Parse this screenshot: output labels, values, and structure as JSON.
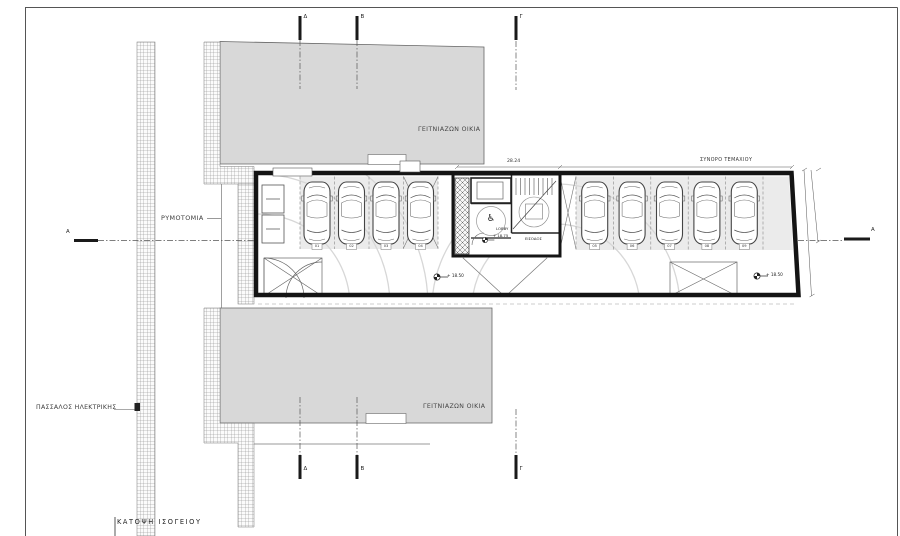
{
  "drawing": {
    "title": "ΚΑΤΟΨΗ ΙΣΟΓΕΙΟΥ",
    "labels": {
      "neighbor_house_top": "ΓΕΙΤΝΙΑΖΩΝ ΟΙΚΙΑ",
      "neighbor_house_bottom": "ΓΕΙΤΝΙΑΖΩΝ ΟΙΚΙΑ",
      "street_alignment": "ΡΥΜΟΤΟΜΙΑ",
      "electric_pole": "ΠΑΣΣΑΛΟΣ ΗΛΕΚΤΡΙΚΗΣ",
      "plot_boundary": "ΣΥΝΟΡΟ ΤΕΜΑΧΙΟΥ",
      "lobby": "LOBBY",
      "entrance": "ΕΙΣΟΔΟΣ"
    },
    "levels": {
      "lobby_level": "+ 18.75",
      "garage_level_left": "+ 18.50",
      "garage_level_right": "+ 18.50"
    },
    "dimensions": {
      "plot_front": "28.24"
    },
    "section_markers": {
      "a": "Α",
      "b": "Β",
      "c": "Γ",
      "d": "Δ"
    },
    "parking_stalls": [
      "01",
      "02",
      "03",
      "04",
      "05",
      "06",
      "07",
      "08",
      "09"
    ],
    "icons": {
      "wheelchair": "♿"
    },
    "colors": {
      "building_fill": "#d8d8d8",
      "wall": "#141414",
      "stall_fill": "#ebebeb",
      "line": "#555555",
      "turning_arc": "#d7d7d7"
    }
  }
}
